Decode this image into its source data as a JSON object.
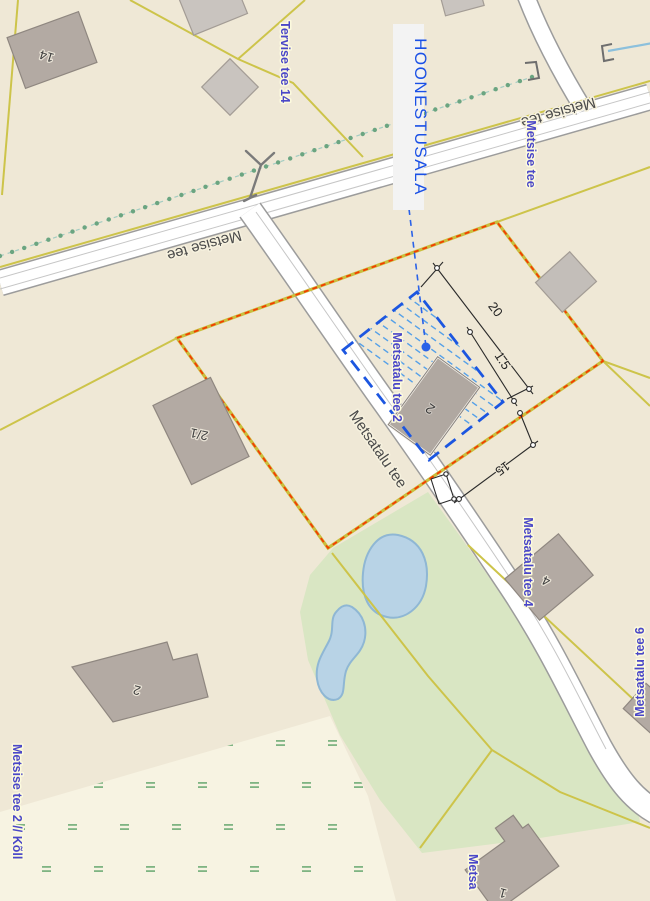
{
  "callout": {
    "hoonestusala": "HOONESTUSALA"
  },
  "road_names": {
    "metsise_left": "Metsise tee",
    "metsise_right": "Metsise tee",
    "metsatalu": "Metsatalu tee"
  },
  "address_labels": {
    "tervise_tee_14": "Tervise tee 14",
    "metsise_tee": "Metsise tee",
    "metsatalu_tee_2": "Metsatalu tee 2",
    "metsatalu_tee_4": "Metsatalu tee 4",
    "metsatalu_tee_6": "Metsatalu tee 6",
    "metsatalu_tee_bottom": "Metsa",
    "metsise_tee_2_koll": "Metsise tee 2 // Kõll"
  },
  "building_numbers": {
    "b14": "14",
    "b21": "2/1",
    "b2_hoonestusala": "2",
    "b4": "4",
    "b2_large": "2",
    "b1": "1"
  },
  "dimensions": {
    "d1": "20",
    "d2": "1.5",
    "d3": "15"
  },
  "colors": {
    "background": "#EFE8D6",
    "wetland": "#F7F3E2",
    "green_area": "#D9E6C3",
    "pond_fill": "#B8D3E6",
    "pond_stroke": "#8FB7D4",
    "road_fill": "#FFFFFF",
    "road_casing": "#9C9C9C",
    "parcel_line_yellow": "#CDC44A",
    "plan_boundary_red": "#F43C00",
    "plan_boundary_yellow": "#C9BE3E",
    "hoonestusala_blue": "#1C56E0",
    "hatch_blue": "#55A0E8",
    "building_fill": "#B3AAA3",
    "building_stroke": "#8F8780",
    "address_label_blue": "#4A47C8",
    "road_label_gray": "#4A4A4A",
    "tree_line_green": "#6BA581",
    "wetland_mark_green": "#7FB482",
    "ditch_blue": "#8CC0DC",
    "symbol_gray": "#7A7A7A"
  }
}
